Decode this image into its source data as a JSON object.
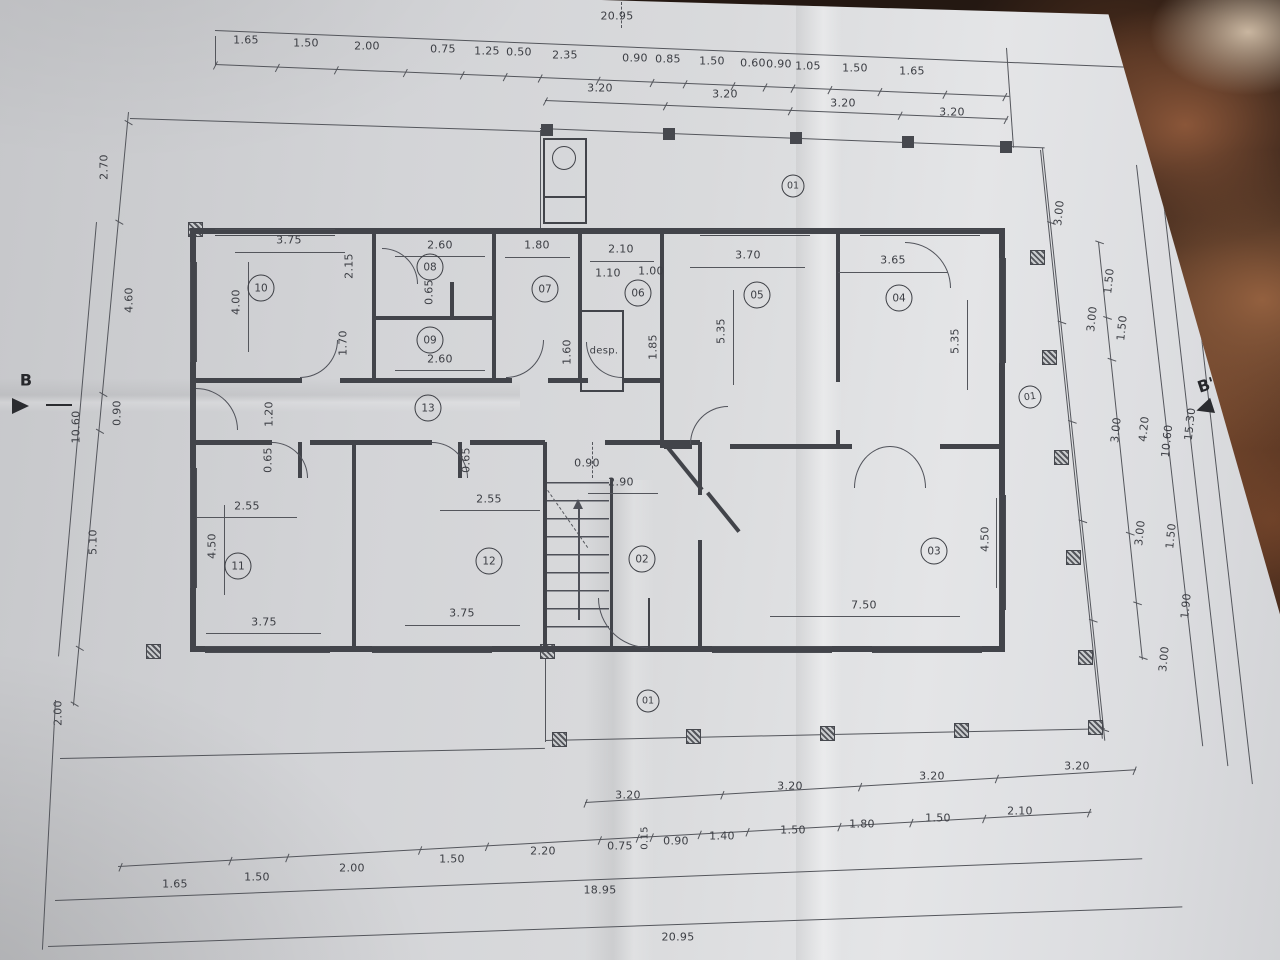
{
  "texts": {
    "desp": "desp.",
    "b": "B",
    "b_prime": "B'"
  },
  "rooms": {
    "n01": "01",
    "n02": "02",
    "n03": "03",
    "n04": "04",
    "n05": "05",
    "n06": "06",
    "n07": "07",
    "n08": "08",
    "n09": "09",
    "n10": "10",
    "n11": "11",
    "n12": "12",
    "n13": "13"
  },
  "dims": {
    "top": {
      "total": "20.95",
      "row1": [
        "1.65",
        "1.50",
        "2.00",
        "0.75",
        "1.25",
        "0.50",
        "2.35",
        "0.90",
        "0.85",
        "1.50",
        "0.60",
        "0.90",
        "1.05",
        "1.50",
        "1.65"
      ],
      "row2": [
        "3.20",
        "3.20",
        "3.20",
        "3.20"
      ]
    },
    "bottom": {
      "row32": [
        "3.20",
        "3.20",
        "3.20",
        "3.20"
      ],
      "row": [
        "1.65",
        "1.50",
        "2.00",
        "1.50",
        "2.20",
        "0.75",
        "0.90",
        "1.40",
        "1.50",
        "1.80",
        "1.50",
        "2.10"
      ],
      "small": "0.15",
      "total1": "18.95",
      "total2": "20.95"
    },
    "left": {
      "chain": [
        "2.70",
        "4.60",
        "0.90",
        "5.10",
        "2.00"
      ],
      "total": "10.60"
    },
    "right": {
      "chain3": [
        "3.00",
        "3.00",
        "3.00",
        "3.00",
        "3.00"
      ],
      "chain15": [
        "1.50",
        "1.50",
        "1.50",
        "1.90"
      ],
      "totals": [
        "4.20",
        "10.60",
        "15.30"
      ]
    },
    "interior": {
      "r10w": "3.75",
      "r10h": "4.00",
      "r08w": "2.60",
      "r08h": "2.15",
      "r08c": "0.65",
      "r09w": "2.60",
      "r09h": "1.70",
      "r07w": "1.80",
      "r07d": "1.60",
      "r06w": "2.10",
      "r06a": "1.10",
      "r06b": "1.00",
      "r06h": "1.85",
      "r05w": "3.70",
      "r05h": "5.35",
      "r04w": "3.65",
      "r04h": "5.35",
      "cor": "1.20",
      "r11c": "0.65",
      "r12c": "0.65",
      "hall_a": "0.90",
      "hall_b": "2.90",
      "r11a": "2.55",
      "r12a": "2.55",
      "r11h": "4.50",
      "r03h": "4.50",
      "r03w": "7.50",
      "r11b": "3.75",
      "r12b": "3.75"
    }
  }
}
